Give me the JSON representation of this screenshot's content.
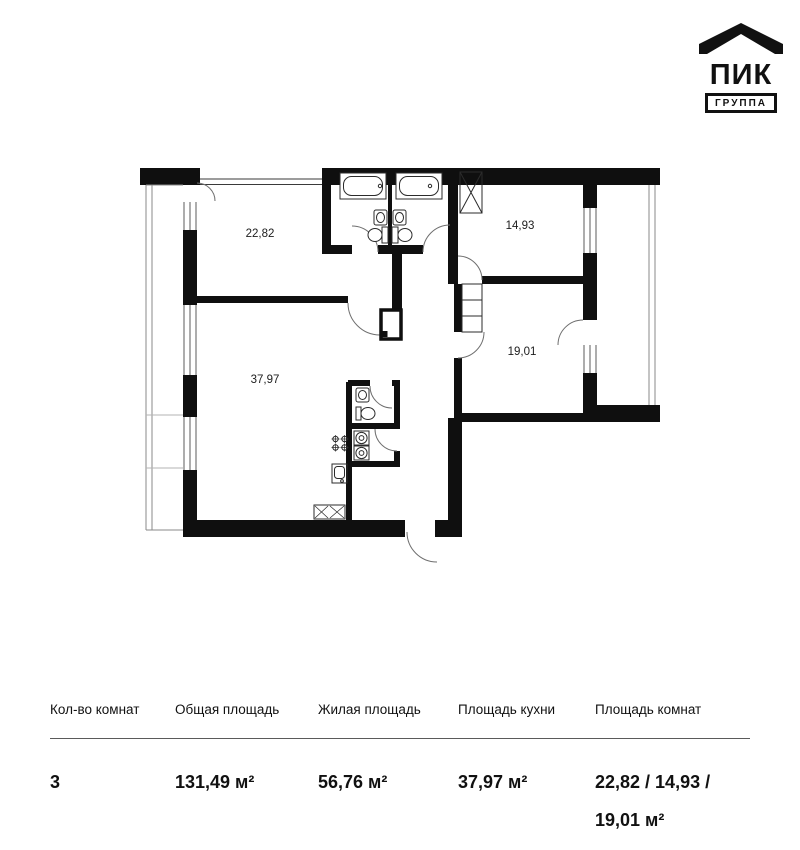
{
  "logo": {
    "brand": "ПИК",
    "group": "ГРУППА"
  },
  "colors": {
    "ink": "#111111",
    "walls": "#0f0f0f"
  },
  "floor_plan": {
    "rooms": [
      {
        "name": "living-room",
        "area": "22,82"
      },
      {
        "name": "bedroom-1",
        "area": "14,93"
      },
      {
        "name": "bedroom-2",
        "area": "19,01"
      },
      {
        "name": "kitchen-living",
        "area": "37,97"
      }
    ]
  },
  "summary_table": {
    "columns": [
      {
        "header": "Кол-во комнат",
        "value": "3"
      },
      {
        "header": "Общая площадь",
        "value": "131,49 м²"
      },
      {
        "header": "Жилая площадь",
        "value": "56,76 м²"
      },
      {
        "header": "Площадь кухни",
        "value": "37,97 м²"
      },
      {
        "header": "Площадь комнат",
        "value": "22,82 / 14,93 / 19,01 м²"
      }
    ]
  }
}
